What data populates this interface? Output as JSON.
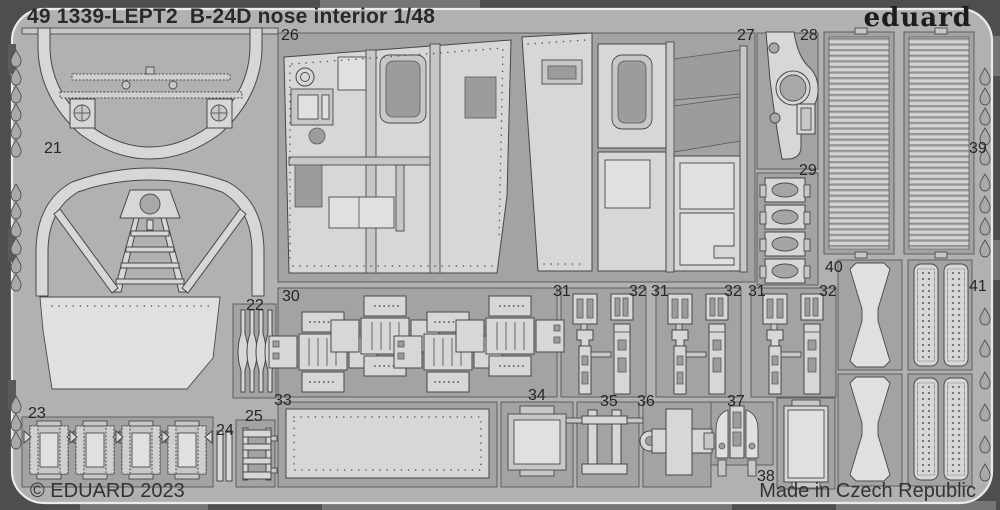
{
  "sheet": {
    "title": "49 1339-LEPT2  B-24D nose interior 1/48",
    "brand": "eduard",
    "copyright": "© EDUARD 2023",
    "made_in": "Made in Czech Republic",
    "part_labels": [
      {
        "number": "21",
        "x": 44,
        "y": 141
      },
      {
        "number": "22",
        "x": 246,
        "y": 298
      },
      {
        "number": "23",
        "x": 28,
        "y": 406
      },
      {
        "number": "24",
        "x": 216,
        "y": 423
      },
      {
        "number": "25",
        "x": 245,
        "y": 409
      },
      {
        "number": "26",
        "x": 281,
        "y": 28
      },
      {
        "number": "27",
        "x": 737,
        "y": 28
      },
      {
        "number": "28",
        "x": 800,
        "y": 28
      },
      {
        "number": "29",
        "x": 799,
        "y": 163
      },
      {
        "number": "30",
        "x": 282,
        "y": 289
      },
      {
        "number": "31",
        "x": 553,
        "y": 284
      },
      {
        "number": "32",
        "x": 629,
        "y": 284
      },
      {
        "number": "31",
        "x": 651,
        "y": 284
      },
      {
        "number": "32",
        "x": 724,
        "y": 284
      },
      {
        "number": "31",
        "x": 748,
        "y": 284
      },
      {
        "number": "32",
        "x": 819,
        "y": 284
      },
      {
        "number": "33",
        "x": 274,
        "y": 393
      },
      {
        "number": "34",
        "x": 528,
        "y": 388
      },
      {
        "number": "35",
        "x": 600,
        "y": 394
      },
      {
        "number": "36",
        "x": 637,
        "y": 394
      },
      {
        "number": "37",
        "x": 727,
        "y": 394
      },
      {
        "number": "38",
        "x": 757,
        "y": 469
      },
      {
        "number": "39",
        "x": 969,
        "y": 141
      },
      {
        "number": "40",
        "x": 825,
        "y": 260
      },
      {
        "number": "41",
        "x": 969,
        "y": 279
      }
    ]
  },
  "colors": {
    "bg": "#4e4e4e",
    "sheet": "#b1b1b1",
    "part": "#d7d7d7",
    "part2": "#c7c7c7",
    "lt": "#e0e0e0",
    "hole": "#9c9c9c",
    "well": "#a3a3a3",
    "ink": "#2a2a2a",
    "edge": "#ebebeb"
  }
}
